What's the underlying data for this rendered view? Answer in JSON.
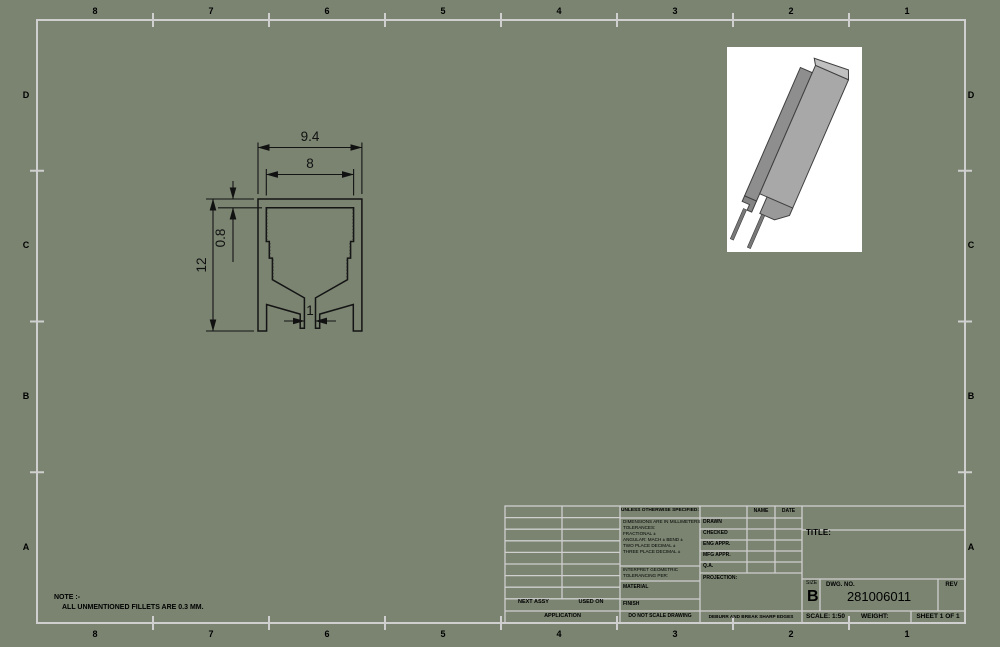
{
  "sheet": {
    "background_color": "#7a8471",
    "format_line_color": "#cfcfcf",
    "zones": {
      "top": [
        "8",
        "7",
        "6",
        "5",
        "4",
        "3",
        "2",
        "1"
      ],
      "bottom": [
        "8",
        "7",
        "6",
        "5",
        "4",
        "3",
        "2",
        "1"
      ],
      "left": [
        "D",
        "C",
        "B",
        "A"
      ],
      "right": [
        "D",
        "C",
        "B",
        "A"
      ]
    }
  },
  "note": {
    "line1": "NOTE :-",
    "line2": "ALL UNMENTIONED FILLETS ARE 0.3 MM."
  },
  "drawing_view": {
    "description": "extrusion-profile-section-view",
    "dims": {
      "overall_width": "9.4",
      "inner_width": "8",
      "overall_height": "12",
      "top_wall_thickness": "0.8",
      "slot_width": "1"
    }
  },
  "title_block": {
    "spec_header": "UNLESS OTHERWISE SPECIFIED:",
    "spec_lines": [
      "DIMENSIONS ARE IN MILLIMETERS",
      "TOLERANCES:",
      "FRACTIONAL ±",
      "ANGULAR: MACH ±   BEND ±",
      "TWO PLACE DECIMAL     ±",
      "THREE PLACE DECIMAL  ±"
    ],
    "interpret_line1": "INTERPRET GEOMETRIC",
    "interpret_line2": "TOLERANCING PER:",
    "material_label": "MATERIAL",
    "finish_label": "FINISH",
    "name_header": "NAME",
    "date_header": "DATE",
    "approvals": [
      "DRAWN",
      "CHECKED",
      "ENG APPR.",
      "MFG APPR.",
      "Q.A."
    ],
    "projection_label": "PROJECTION:",
    "next_assy": "NEXT ASSY",
    "used_on": "USED ON",
    "application": "APPLICATION",
    "do_not_scale": "DO NOT SCALE DRAWING",
    "deburr": "DEBURR AND BREAK SHARP EDGES",
    "title_label": "TITLE:",
    "size_label": "SIZE",
    "size_value": "B",
    "dwg_label": "DWG.  NO.",
    "dwg_value": "281006011",
    "rev_label": "REV",
    "scale_text": "SCALE: 1:50",
    "weight_text": "WEIGHT:",
    "sheet_text": "SHEET 1 OF 1"
  }
}
